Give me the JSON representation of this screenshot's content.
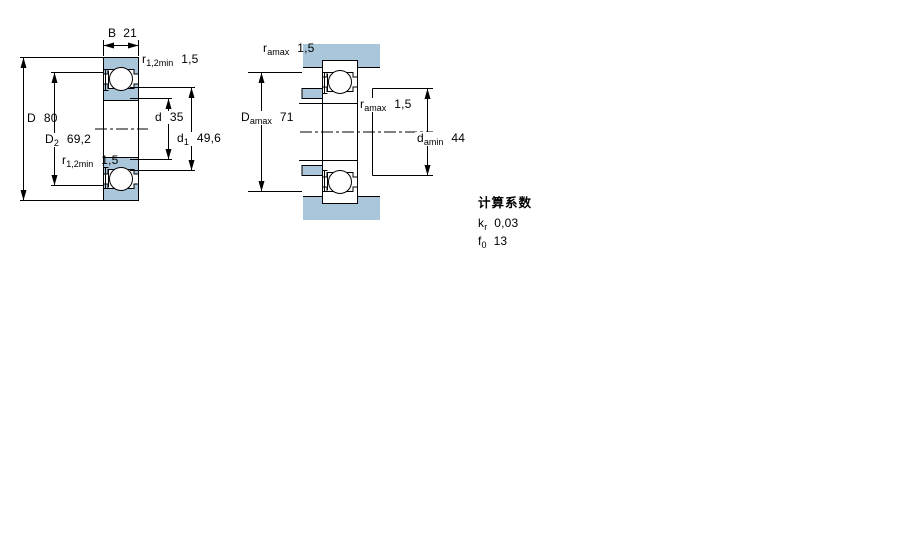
{
  "colors": {
    "steel_blue": "#a9c6da",
    "line_black": "#000000",
    "background": "#ffffff"
  },
  "left_figure": {
    "name": "bearing cross-section drawing",
    "dims": {
      "B": {
        "symbol": "B",
        "subscript": "",
        "value": "21"
      },
      "r12_top": {
        "symbol": "r",
        "subscript": "1,2min",
        "value": "1,5"
      },
      "D": {
        "symbol": "D",
        "subscript": "",
        "value": "80"
      },
      "D2": {
        "symbol": "D",
        "subscript": "2",
        "value": "69,2"
      },
      "r12_mid": {
        "symbol": "r",
        "subscript": "1,2min",
        "value": "1,5"
      },
      "d": {
        "symbol": "d",
        "subscript": "",
        "value": "35"
      },
      "d1": {
        "symbol": "d",
        "subscript": "1",
        "value": "49,6"
      }
    }
  },
  "right_figure": {
    "name": "abutment and fillet dimensions drawing",
    "dims": {
      "ra_top": {
        "symbol": "r",
        "subscript": "amax",
        "value": "1,5"
      },
      "Da": {
        "symbol": "D",
        "subscript": "amax",
        "value": "71"
      },
      "ra_mid": {
        "symbol": "r",
        "subscript": "amax",
        "value": "1,5"
      },
      "da": {
        "symbol": "d",
        "subscript": "amin",
        "value": "44"
      }
    }
  },
  "calculation_factors": {
    "title": "计算系数",
    "rows": [
      {
        "symbol": "k",
        "subscript": "r",
        "value": "0,03"
      },
      {
        "symbol": "f",
        "subscript": "0",
        "value": "13"
      }
    ]
  }
}
